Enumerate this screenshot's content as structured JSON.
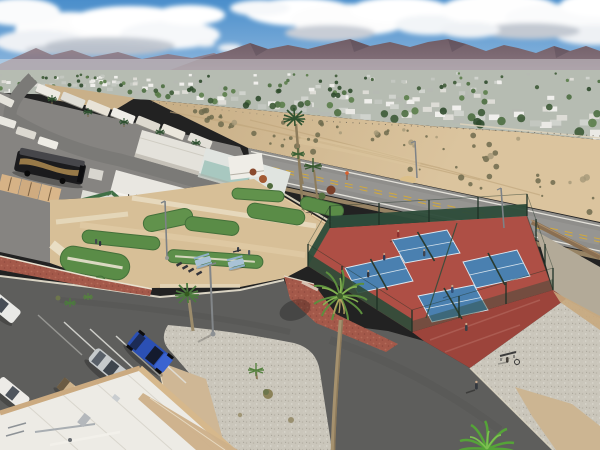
{
  "meta": {
    "title": "Aerial drone photograph of a desert RV resort with pickleball courts, mini golf course, parking lot and mobile-home community below a mountain range",
    "type": "aerial-drone-photograph",
    "time_of_day": "daytime, scattered clouds"
  },
  "colors": {
    "skyTop": "#4a8ecb",
    "skyHorizon": "#9cc0e2",
    "cloudWhite": "#fdfdfd",
    "cloudShade": "#b8bfca",
    "mountainFar": "#8d7a84",
    "mountain": "#6f5d66",
    "townBase": "#b6bcb2",
    "sand": "#cdb48e",
    "sandLight": "#d9c29c",
    "roadAsphalt": "#8f8e8b",
    "driveAsphalt": "#5e5e5c",
    "gravel": "#cac6bb",
    "gravelShade": "#b3aa98",
    "turfGreen": "#5a8c47",
    "turfLight": "#7fae65",
    "courtRed": "#ae4f45",
    "courtRedDark": "#9c443b",
    "courtBlue": "#4a80b0",
    "lineWhite": "#e8eef2",
    "fenceGreen": "#2e4c3a",
    "wallTan": "#caa87e",
    "brickRed": "#a4594a",
    "roofWhite": "#edebe5",
    "palmGreen": "#5d8f3e",
    "palmBright": "#86b452",
    "carBlue": "#2b50b4",
    "carSilver": "#c6cacc",
    "cartTan": "#cdb28b",
    "busBlack": "#1b1b1d",
    "yellowLine": "#d2a93c",
    "sidewalkTan": "#cfb795",
    "greenRoof": "#3f6f46"
  },
  "scene": {
    "sky": {
      "label": "blue sky with scattered cumulus clouds"
    },
    "mountains": {
      "label": "desert mountain range on horizon"
    },
    "town": {
      "label": "mobile-home community band",
      "houses": 150,
      "trees": 110
    },
    "desert_lot": {
      "label": "vacant sandy lot with scrub brush",
      "shrubs": 58,
      "dry_shrubs": 12
    },
    "main_road": {
      "label": "two-lane paved road",
      "center_line": "dashed double yellow",
      "edge_lines": "white",
      "marker": "small orange roadside marker"
    },
    "rv_park": {
      "label": "RV park with palm-lined street",
      "rvs": 11,
      "street_palms": 5,
      "motorcoach": "black luxury motorcoach",
      "buildings": [
        "green-roof office building",
        "white mobile homes",
        "tan storage sheds",
        "white trailer"
      ]
    },
    "mini_golf": {
      "label": "miniature golf course on sand",
      "greens": 9,
      "picnic_tables": 2,
      "people": 4,
      "bike_rack_bikes": 3
    },
    "pickleball": {
      "label": "fenced pickleball complex",
      "courts": 4,
      "surface": "red apron with blue courts",
      "fence": "dark green chain-link with windscreens",
      "players": 6
    },
    "parking": {
      "label": "asphalt parking lot",
      "vehicles": [
        "blue SUV",
        "silver sedan",
        "white car",
        "white car at edge",
        "tan golf cart"
      ],
      "stripes": 5
    },
    "foreground": {
      "building": "white flat-roof building corner with tan parapet",
      "gravel": "white rock landscaping with palms",
      "light_poles": 2,
      "road_poles": 2,
      "bench_person": 1,
      "walking_person": 1
    }
  }
}
